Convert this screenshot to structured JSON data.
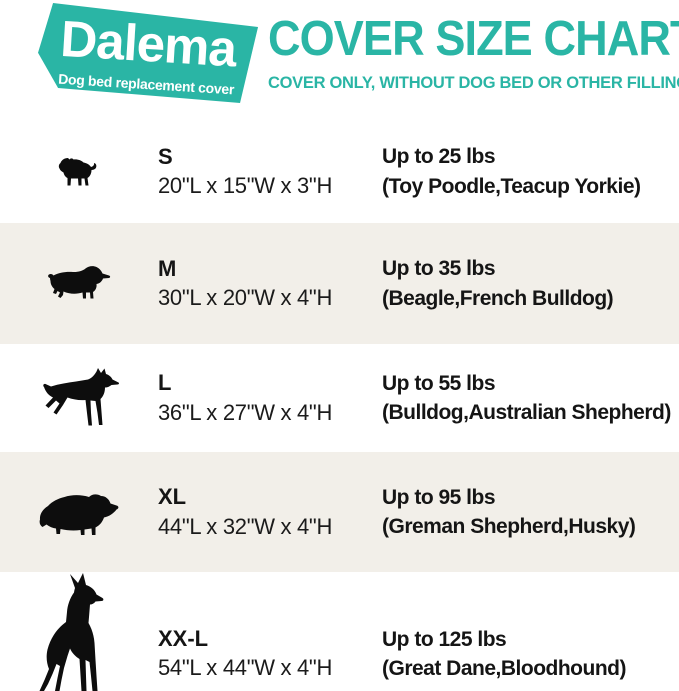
{
  "brand": {
    "name": "Dalema",
    "tagline": "Dog bed replacement cover"
  },
  "header": {
    "title": "COVER SIZE CHART",
    "subtitle": "COVER ONLY, WITHOUT DOG BED OR OTHER FILLINGS"
  },
  "colors": {
    "accent_teal": "#2ab5a5",
    "alt_row_bg": "#f2efe9",
    "logo_text": "#ffffff",
    "body_text": "#151515",
    "silhouette": "#0d0d0d"
  },
  "chart_data": {
    "type": "table",
    "title": "COVER SIZE CHART",
    "subtitle": "COVER ONLY, WITHOUT DOG BED OR OTHER FILLINGS",
    "columns": [
      "Dog silhouette",
      "Size",
      "Dimensions",
      "Weight capacity",
      "Example breeds"
    ],
    "rows": [
      {
        "size": "S",
        "dimensions": "20\"L x 15\"W x 3\"H",
        "weight": "Up to 25 lbs",
        "breeds": "(Toy Poodle,Teacup Yorkie)",
        "icon": "pug-silhouette"
      },
      {
        "size": "M",
        "dimensions": "30\"L x 20\"W x 4\"H",
        "weight": "Up to 35 lbs",
        "breeds": "(Beagle,French Bulldog)",
        "icon": "spaniel-silhouette"
      },
      {
        "size": "L",
        "dimensions": "36\"L x 27\"W x 4\"H",
        "weight": "Up to 55 lbs",
        "breeds": "(Bulldog,Australian Shepherd)",
        "icon": "doberman-silhouette"
      },
      {
        "size": "XL",
        "dimensions": "44\"L x 32\"W x 4\"H",
        "weight": "Up to 95 lbs",
        "breeds": "(Greman Shepherd,Husky)",
        "icon": "fluffy-dog-silhouette"
      },
      {
        "size": "XX-L",
        "dimensions": "54\"L x 44\"W x 4\"H",
        "weight": "Up to 125 lbs",
        "breeds": "(Great Dane,Bloodhound)",
        "icon": "great-dane-silhouette"
      }
    ]
  }
}
